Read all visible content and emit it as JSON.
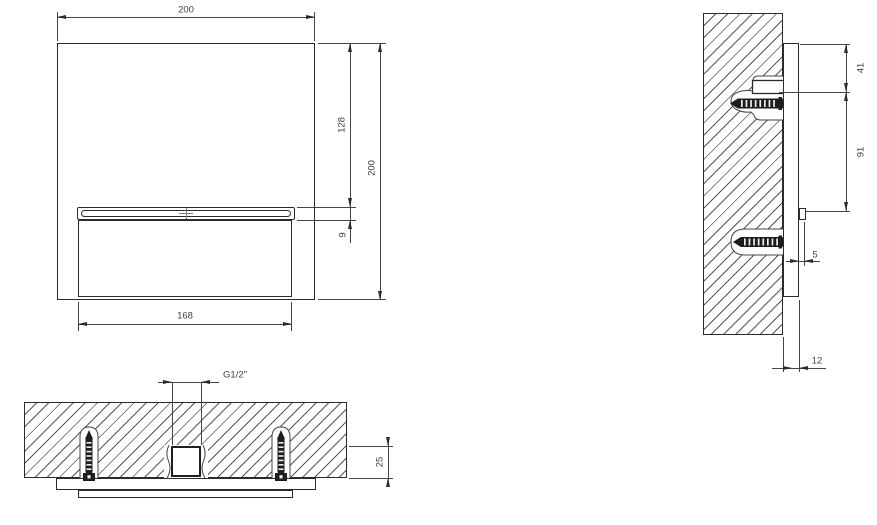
{
  "drawing": {
    "type": "installation technical drawing, three orthographic views",
    "colors": {
      "line": "#2b2b2e",
      "dim_line": "#45454c",
      "hatch": "#55555c",
      "text": "#404047",
      "background": "#ffffff"
    },
    "dimensions": {
      "front_width_top": "200",
      "front_slot_offset": "128",
      "front_slot_height": "9",
      "front_height": "200",
      "front_spout_width": "168",
      "side_top_to_anchor": "41",
      "side_anchor_to_spout": "91",
      "side_lip_depth": "5",
      "side_plate_depth": "12",
      "plan_inlet_thread": "G1/2\"",
      "plan_recess_depth": "25"
    }
  }
}
